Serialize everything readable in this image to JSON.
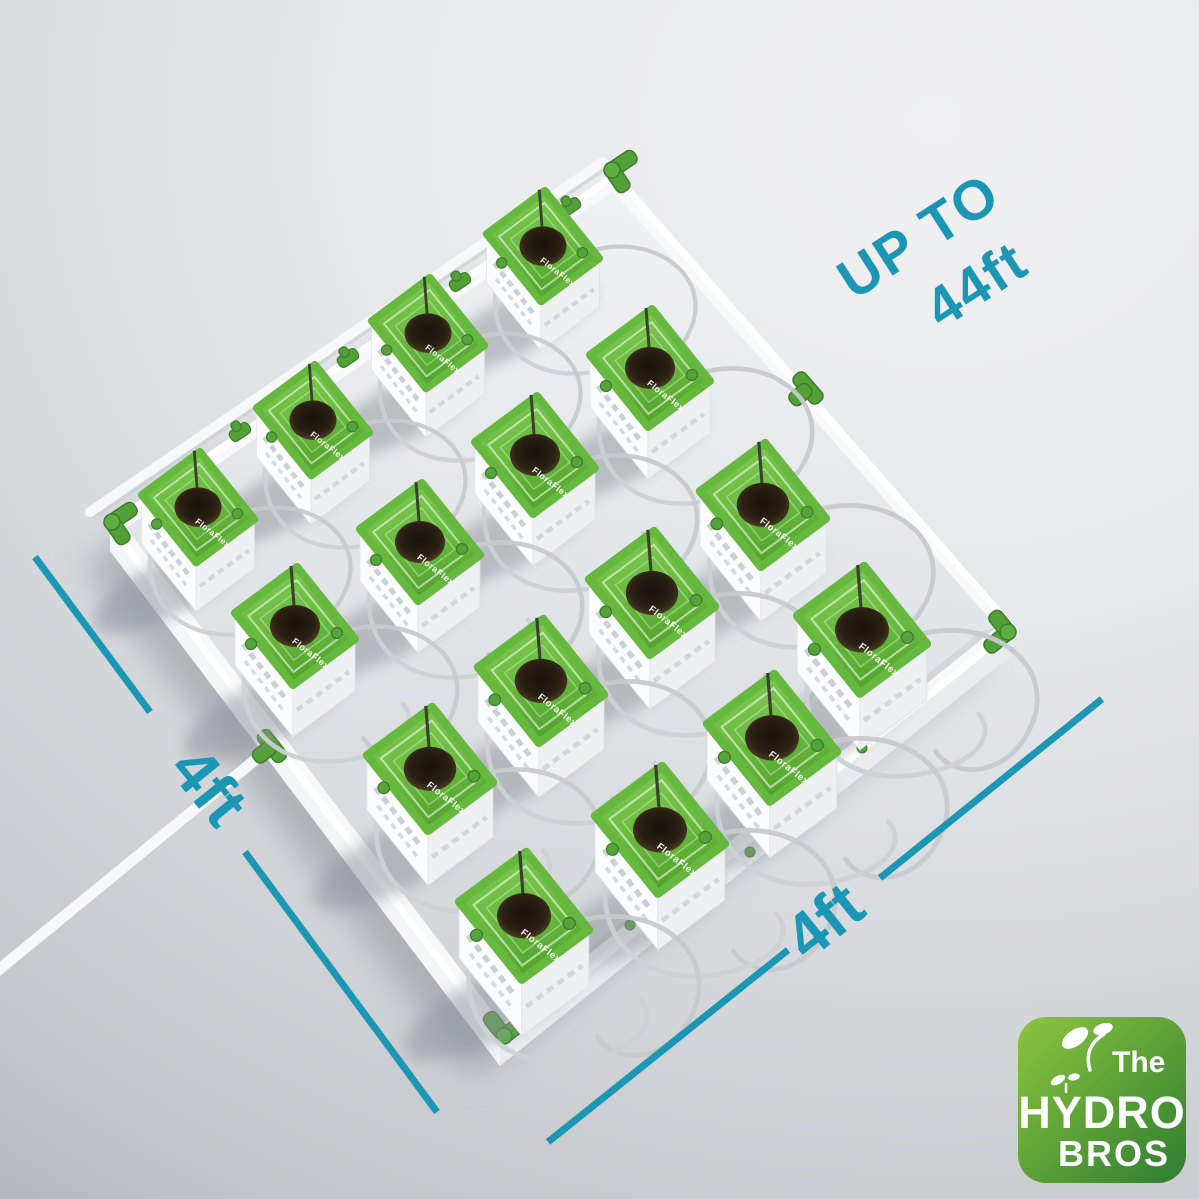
{
  "annotations": {
    "up_to_line1": "UP TO",
    "up_to_line2": "44ft",
    "left_dim_label": "4ft",
    "bottom_dim_label": "4ft"
  },
  "logo": {
    "word1": "The",
    "word2": "HYDRO",
    "word3": "BROS"
  },
  "scene": {
    "cube_brand": "FloraFlex",
    "grid": {
      "rows": 4,
      "cols": 4,
      "total_cubes": 16
    },
    "colors": {
      "accent": "#1b96b4",
      "cube_green_light": "#7cc653",
      "cube_green_dark": "#58a832",
      "fitting_green": "#54a038",
      "fitting_green_dark": "#3c7c2a",
      "pipe_white": "#f7f8f9",
      "tube_gray": "#c6cacd",
      "logo_green_light": "#8cc63e",
      "logo_green_dark": "#2e7d31"
    },
    "cubes": [
      {
        "x": 543,
        "y": 248,
        "s": 0.94
      },
      {
        "x": 428,
        "y": 335,
        "s": 0.94
      },
      {
        "x": 313,
        "y": 422,
        "s": 0.94
      },
      {
        "x": 198,
        "y": 509,
        "s": 0.94
      },
      {
        "x": 650,
        "y": 370,
        "s": 1.0
      },
      {
        "x": 535,
        "y": 457,
        "s": 1.0
      },
      {
        "x": 420,
        "y": 544,
        "s": 1.0
      },
      {
        "x": 295,
        "y": 628,
        "s": 1.0
      },
      {
        "x": 763,
        "y": 507,
        "s": 1.05
      },
      {
        "x": 652,
        "y": 595,
        "s": 1.05
      },
      {
        "x": 541,
        "y": 683,
        "s": 1.05
      },
      {
        "x": 430,
        "y": 771,
        "s": 1.05
      },
      {
        "x": 862,
        "y": 632,
        "s": 1.08
      },
      {
        "x": 772,
        "y": 740,
        "s": 1.08
      },
      {
        "x": 660,
        "y": 832,
        "s": 1.08
      },
      {
        "x": 524,
        "y": 918,
        "s": 1.08
      }
    ],
    "dimension_lines": {
      "left": {
        "segments": [
          [
            35,
            557,
            150,
            712
          ],
          [
            245,
            852,
            437,
            1112
          ]
        ],
        "label_x": 192,
        "label_y": 800,
        "rotate": 51
      },
      "bottom": {
        "segments": [
          [
            548,
            1142,
            788,
            950
          ],
          [
            880,
            878,
            1102,
            699
          ]
        ],
        "label_x": 838,
        "label_y": 938,
        "rotate": -38.8
      }
    },
    "up_to": {
      "x": 929,
      "y": 252,
      "rotate": -33
    }
  }
}
